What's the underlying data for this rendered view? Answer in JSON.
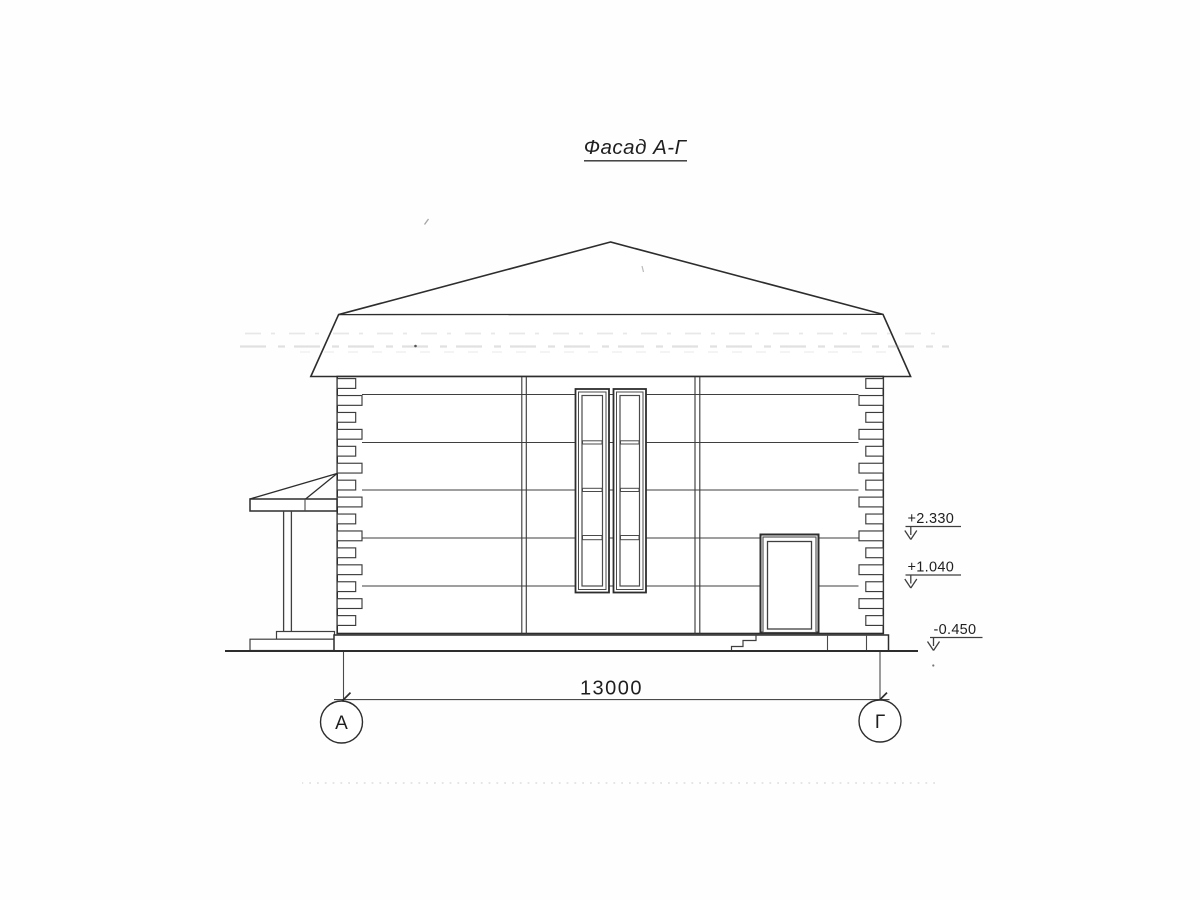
{
  "drawing": {
    "title": "Фасад А-Г",
    "dimension_label": "13000",
    "axis_markers": [
      {
        "label": "А"
      },
      {
        "label": "Г"
      }
    ],
    "elevation_marks": [
      {
        "value": "+2.330"
      },
      {
        "value": "+1.040"
      },
      {
        "value": "-0.450"
      }
    ],
    "colors": {
      "ink": "#2d2d2d",
      "paper": "#fefefe"
    }
  }
}
